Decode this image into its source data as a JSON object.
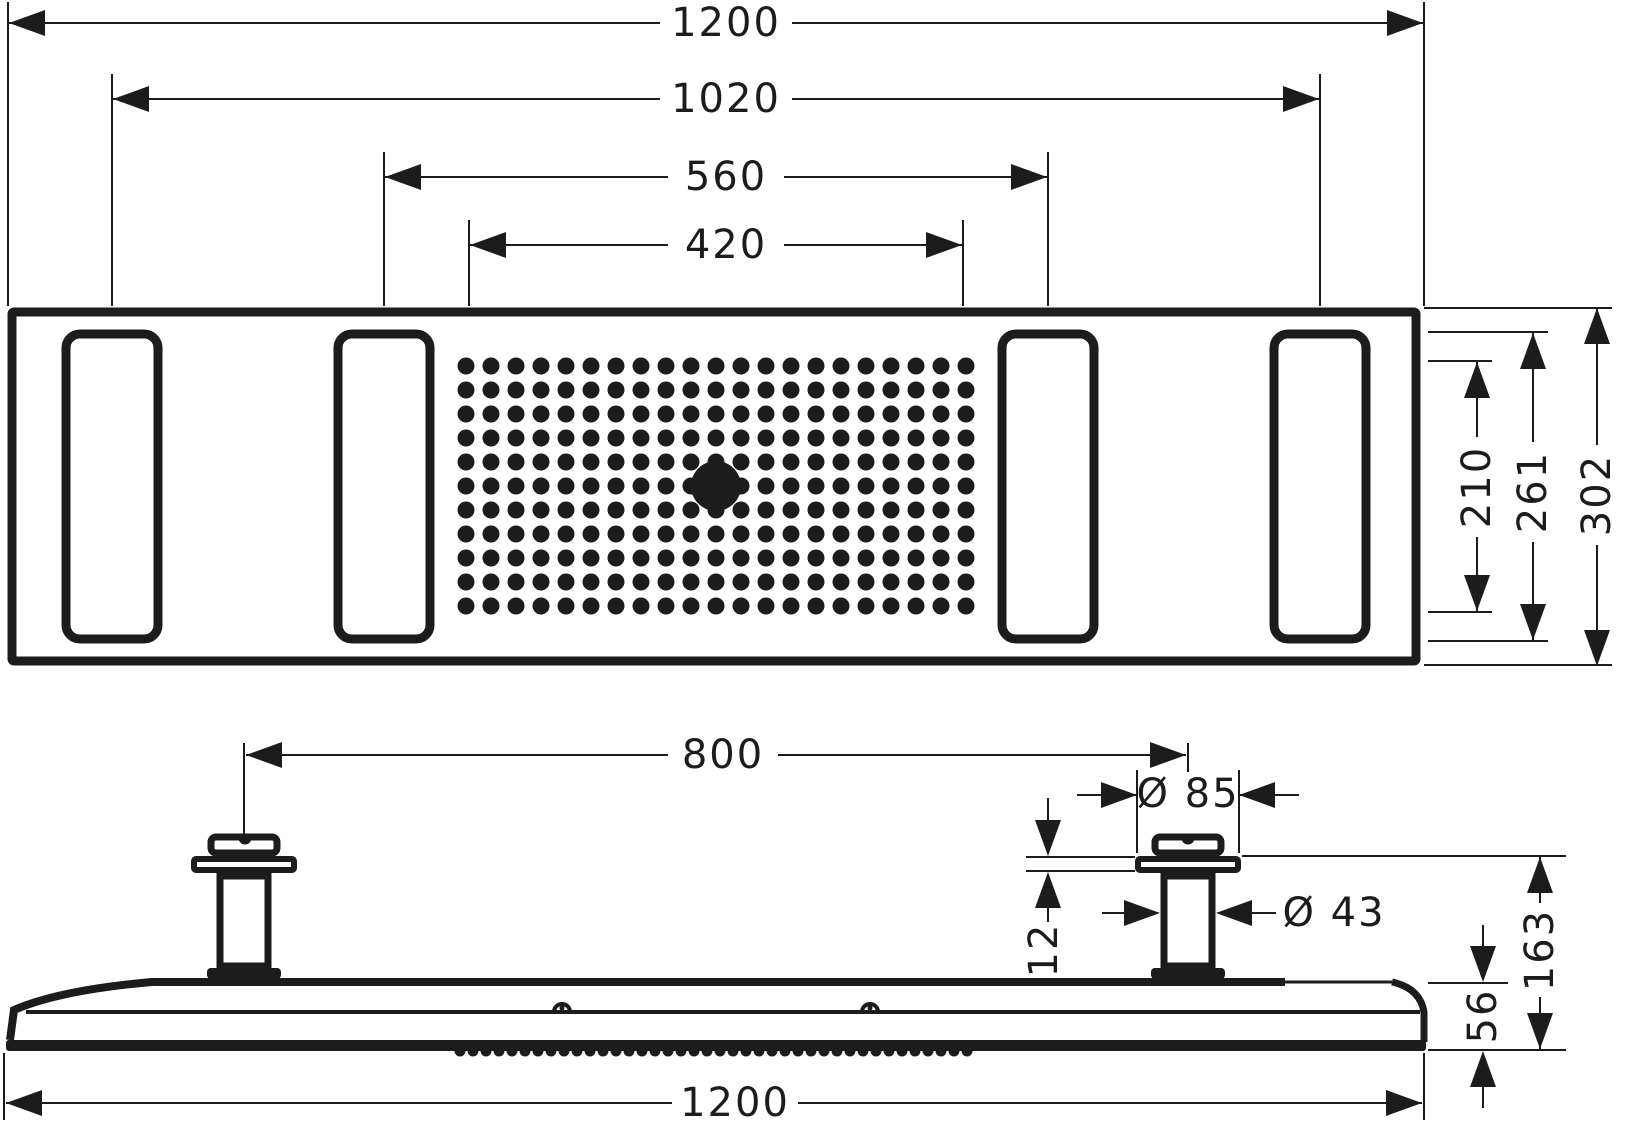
{
  "colors": {
    "ink": "#1c1c1c",
    "paper": "#ffffff"
  },
  "top_view": {
    "dimensions": {
      "overall_width": {
        "label": "1200"
      },
      "outer_connections_span": {
        "label": "1020"
      },
      "inner_connections_span": {
        "label": "560"
      },
      "spray_field_width": {
        "label": "420"
      },
      "spray_field_depth": {
        "label": "210"
      },
      "body_inner_depth": {
        "label": "261"
      },
      "overall_depth": {
        "label": "302"
      }
    },
    "spray_grid": {
      "cols": 21,
      "rows": 11,
      "origin_x": 466,
      "origin_y": 366,
      "step_x": 25,
      "step_y": 24,
      "dot_radius": 8.5,
      "center_col": 10,
      "center_row": 5,
      "center_outlet_radius": 25
    }
  },
  "side_view": {
    "dimensions": {
      "connector_spacing": {
        "label": "800"
      },
      "connector_cap_diameter": {
        "label": "Ø 85"
      },
      "connector_pipe_diameter": {
        "label": "Ø 43"
      },
      "flange_thickness": {
        "label": "12"
      },
      "installation_height": {
        "label": "163"
      },
      "body_thickness": {
        "label": "56"
      },
      "overall_width": {
        "label": "1200"
      }
    },
    "nozzle_band": {
      "teeth": 40,
      "start_x": 460,
      "step": 13,
      "radius": 5.5
    }
  }
}
